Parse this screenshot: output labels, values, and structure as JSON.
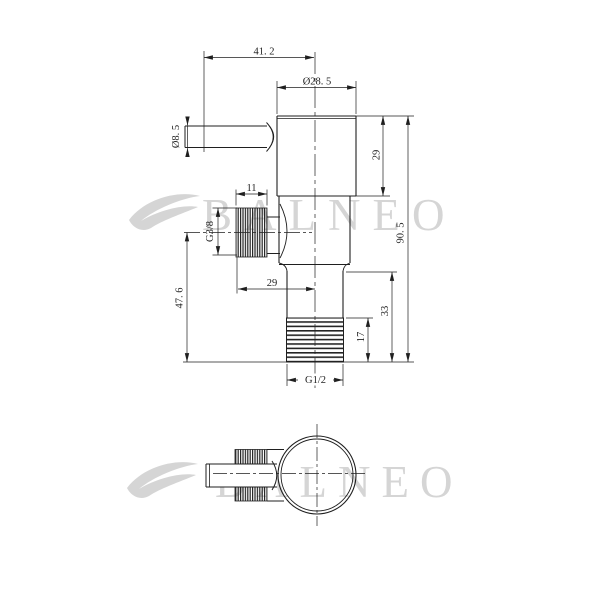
{
  "watermark": {
    "text": "BALNEO",
    "color": "#d5d5d5"
  },
  "drawing": {
    "type": "technical-dimension-drawing",
    "subject": "angle-valve",
    "line_color": "#1f1f1f",
    "front_view": {
      "dimensions": {
        "handle_offset_width": "41. 2",
        "body_diameter": "Ø28. 5",
        "handle_diameter": "Ø8. 5",
        "cap_height": "29",
        "overall_height": "90. 5",
        "side_thread_length": "11",
        "side_thread_size": "G3/8",
        "side_port_height": "47. 6",
        "side_port_offset": "29",
        "lower_section_height": "33",
        "bottom_thread_length": "17",
        "bottom_thread_size": "G1/2"
      }
    }
  }
}
